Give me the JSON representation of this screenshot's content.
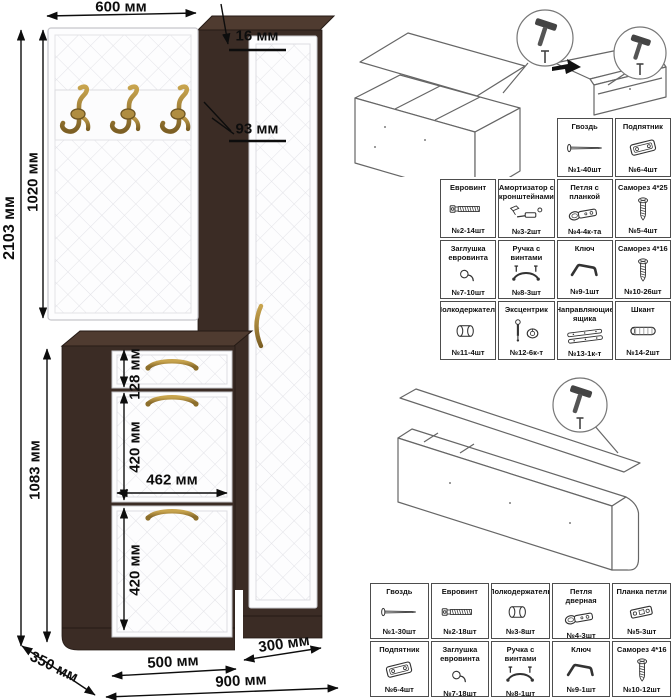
{
  "drawing": {
    "dimensions": {
      "top_width": "600 мм",
      "panel_thickness": "16 мм",
      "side_depth": "93 мм",
      "panel_height": "1020 мм",
      "total_height": "2103 мм",
      "cabinet_height": "1083 мм",
      "drawer_height": "128 мм",
      "flap1_height": "420 мм",
      "flap_width": "462 мм",
      "flap2_height": "420 мм",
      "depth": "350 мм",
      "cabinet_width": "500 мм",
      "column_width": "300 мм",
      "total_width": "900 мм"
    },
    "hooks_count": 3,
    "colors": {
      "wenge": "#3b2c25",
      "front_white": "#fdfdfe",
      "brass": "#a9853b",
      "dimension_line": "#111111"
    }
  },
  "hardware_tables": {
    "top": {
      "rows": [
        {
          "offset": 2,
          "cells": [
            {
              "name": "Гвоздь",
              "qty": "№1-40шт",
              "icon": "nail-icon"
            },
            {
              "name": "Подпятник",
              "qty": "№6-4шт",
              "icon": "glide-icon"
            }
          ]
        },
        {
          "offset": 0,
          "cells": [
            {
              "name": "Евровинт",
              "qty": "№2-14шт",
              "icon": "confirmat-icon"
            },
            {
              "name": "Амортизатор с кронштейнами",
              "qty": "№3-2шт",
              "icon": "gas-lift-icon"
            },
            {
              "name": "Петля с планкой",
              "qty": "№4-4к-та",
              "icon": "hinge-icon"
            },
            {
              "name": "Саморез 4*25",
              "qty": "№5-4шт",
              "icon": "screw-icon"
            }
          ]
        },
        {
          "offset": 0,
          "cells": [
            {
              "name": "Заглушка евровинта",
              "qty": "№7-10шт",
              "icon": "cap-icon"
            },
            {
              "name": "Ручка с винтами",
              "qty": "№8-3шт",
              "icon": "handle-icon"
            },
            {
              "name": "Ключ",
              "qty": "№9-1шт",
              "icon": "hex-key-icon"
            },
            {
              "name": "Саморез 4*16",
              "qty": "№10-26шт",
              "icon": "screw-icon"
            }
          ]
        },
        {
          "offset": 0,
          "cells": [
            {
              "name": "Полкодержатель",
              "qty": "№11-4шт",
              "icon": "shelf-pin-icon"
            },
            {
              "name": "Эксцентрик",
              "qty": "№12-6к-т",
              "icon": "cam-lock-icon"
            },
            {
              "name": "Направляющие ящика",
              "qty": "№13-1к-т",
              "icon": "drawer-slides-icon"
            },
            {
              "name": "Шкант",
              "qty": "№14-2шт",
              "icon": "dowel-icon"
            }
          ]
        }
      ]
    },
    "bottom": {
      "rows": [
        {
          "offset": 0,
          "cells": [
            {
              "name": "Гвоздь",
              "qty": "№1-30шт",
              "icon": "nail-icon"
            },
            {
              "name": "Евровинт",
              "qty": "№2-18шт",
              "icon": "confirmat-icon"
            },
            {
              "name": "Полкодержатель",
              "qty": "№3-8шт",
              "icon": "shelf-pin-icon"
            },
            {
              "name": "Петля дверная",
              "qty": "№4-3шт",
              "icon": "hinge-icon"
            },
            {
              "name": "Планка петли",
              "qty": "№5-3шт",
              "icon": "hinge-plate-icon"
            }
          ]
        },
        {
          "offset": 0,
          "cells": [
            {
              "name": "Подпятник",
              "qty": "№6-4шт",
              "icon": "glide-icon"
            },
            {
              "name": "Заглушка евровинта",
              "qty": "№7-18шт",
              "icon": "cap-icon"
            },
            {
              "name": "Ручка с винтами",
              "qty": "№8-1шт",
              "icon": "handle-icon"
            },
            {
              "name": "Ключ",
              "qty": "№9-1шт",
              "icon": "hex-key-icon"
            },
            {
              "name": "Саморез 4*16",
              "qty": "№10-12шт",
              "icon": "screw-icon"
            }
          ]
        }
      ]
    }
  }
}
